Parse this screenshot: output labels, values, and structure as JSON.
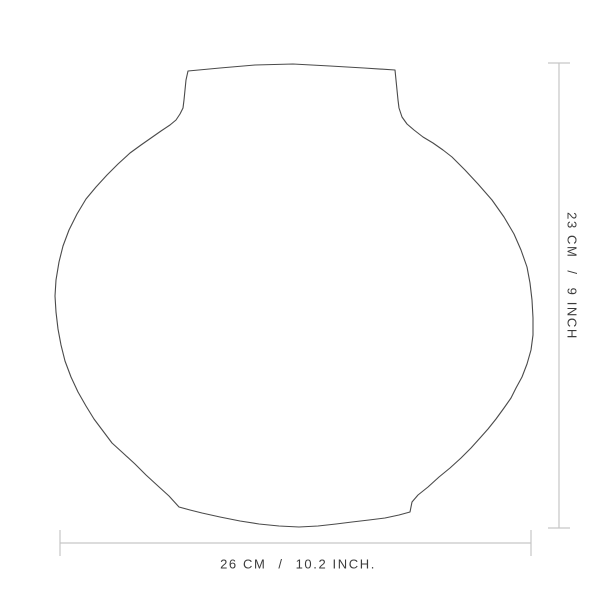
{
  "figure": {
    "type": "product-dimension-diagram",
    "subject": "round vase outline drawing",
    "background_color": "#ffffff",
    "outline_color": "#4a4a4a",
    "dimension_line_color": "#c6c6c6",
    "label_color": "#3b3b3b",
    "vase_outline": [
      [
        188,
        71
      ],
      [
        220,
        68
      ],
      [
        255,
        65
      ],
      [
        293,
        64
      ],
      [
        330,
        66
      ],
      [
        364,
        68
      ],
      [
        395,
        70
      ],
      [
        396,
        80
      ],
      [
        397,
        90
      ],
      [
        398,
        100
      ],
      [
        399,
        108
      ],
      [
        402,
        117
      ],
      [
        407,
        124
      ],
      [
        414,
        130
      ],
      [
        423,
        137
      ],
      [
        433,
        143
      ],
      [
        443,
        150
      ],
      [
        452,
        157
      ],
      [
        465,
        170
      ],
      [
        478,
        184
      ],
      [
        492,
        200
      ],
      [
        504,
        217
      ],
      [
        514,
        234
      ],
      [
        521,
        250
      ],
      [
        527,
        267
      ],
      [
        530,
        283
      ],
      [
        532,
        300
      ],
      [
        533,
        318
      ],
      [
        533,
        335
      ],
      [
        531,
        350
      ],
      [
        527,
        364
      ],
      [
        522,
        377
      ],
      [
        516,
        388
      ],
      [
        511,
        398
      ],
      [
        504,
        408
      ],
      [
        496,
        419
      ],
      [
        488,
        429
      ],
      [
        480,
        438
      ],
      [
        471,
        448
      ],
      [
        461,
        458
      ],
      [
        450,
        468
      ],
      [
        439,
        477
      ],
      [
        428,
        487
      ],
      [
        418,
        495
      ],
      [
        412,
        502
      ],
      [
        410,
        512
      ],
      [
        399,
        515
      ],
      [
        385,
        518
      ],
      [
        369,
        520
      ],
      [
        352,
        522
      ],
      [
        336,
        524
      ],
      [
        318,
        526
      ],
      [
        299,
        527
      ],
      [
        279,
        526
      ],
      [
        259,
        524
      ],
      [
        240,
        521
      ],
      [
        220,
        517
      ],
      [
        202,
        513
      ],
      [
        190,
        510
      ],
      [
        179,
        507
      ],
      [
        169,
        496
      ],
      [
        158,
        486
      ],
      [
        146,
        475
      ],
      [
        135,
        464
      ],
      [
        123,
        453
      ],
      [
        112,
        443
      ],
      [
        103,
        431
      ],
      [
        94,
        419
      ],
      [
        86,
        406
      ],
      [
        78,
        392
      ],
      [
        71,
        377
      ],
      [
        65,
        361
      ],
      [
        61,
        345
      ],
      [
        58,
        329
      ],
      [
        56,
        312
      ],
      [
        55,
        296
      ],
      [
        56,
        280
      ],
      [
        59,
        262
      ],
      [
        63,
        246
      ],
      [
        69,
        230
      ],
      [
        77,
        214
      ],
      [
        86,
        199
      ],
      [
        96,
        187
      ],
      [
        107,
        175
      ],
      [
        118,
        164
      ],
      [
        130,
        153
      ],
      [
        141,
        145
      ],
      [
        151,
        138
      ],
      [
        161,
        131
      ],
      [
        170,
        125
      ],
      [
        176,
        120
      ],
      [
        180,
        114
      ],
      [
        183,
        108
      ],
      [
        184,
        100
      ],
      [
        185,
        90
      ],
      [
        186,
        80
      ]
    ]
  },
  "dimensions": {
    "width": {
      "metric": "26 CM",
      "separator": "/",
      "imperial": "10.2 INCH."
    },
    "height": {
      "metric": "23 CM",
      "separator": "/",
      "imperial": "9 INCH"
    }
  }
}
